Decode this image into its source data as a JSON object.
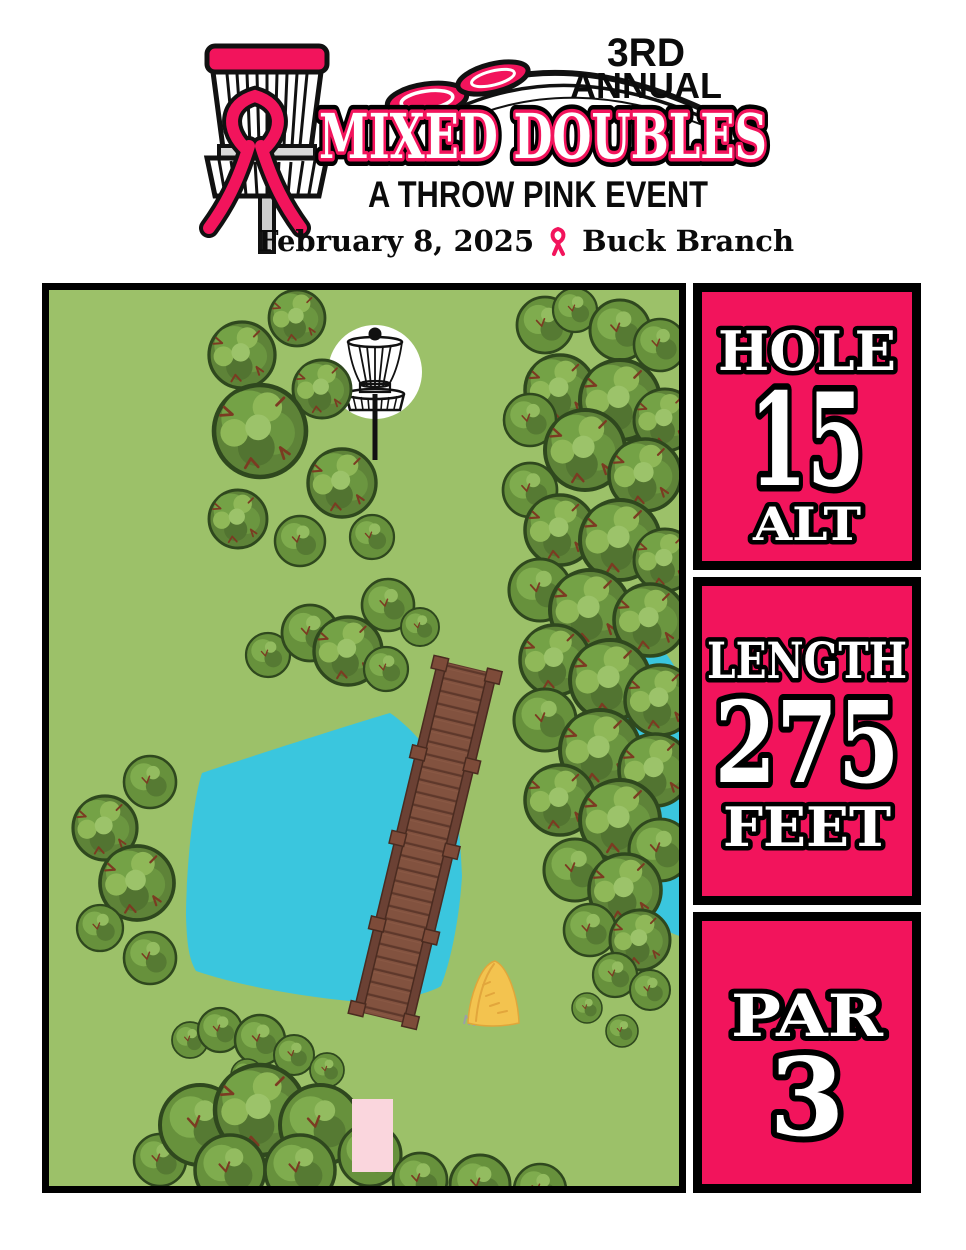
{
  "header": {
    "edition_line1": "3RD",
    "edition_line2": "ANNUAL",
    "title": "MIXED DOUBLES",
    "subtitle": "A THROW PINK EVENT",
    "date": "February 8, 2025",
    "location": "Buck Branch"
  },
  "info_panels": {
    "hole": {
      "label": "HOLE",
      "value": "15",
      "suffix": "ALT"
    },
    "length": {
      "label": "LENGTH",
      "value": "275",
      "unit": "FEET"
    },
    "par": {
      "label": "PAR",
      "value": "3"
    }
  },
  "map_features": [
    "disc-golf-basket",
    "trees",
    "pond",
    "creek",
    "wooden-bridge",
    "hay-bale",
    "tee-pad"
  ],
  "colors": {
    "pink": "#F2145C",
    "light_pink": "#FAD6DD",
    "grass": "#9CC169",
    "water": "#3AC6DE",
    "wood": "#82523F",
    "hay": "#F3C34F",
    "text_dark": "#0B0B0B"
  }
}
